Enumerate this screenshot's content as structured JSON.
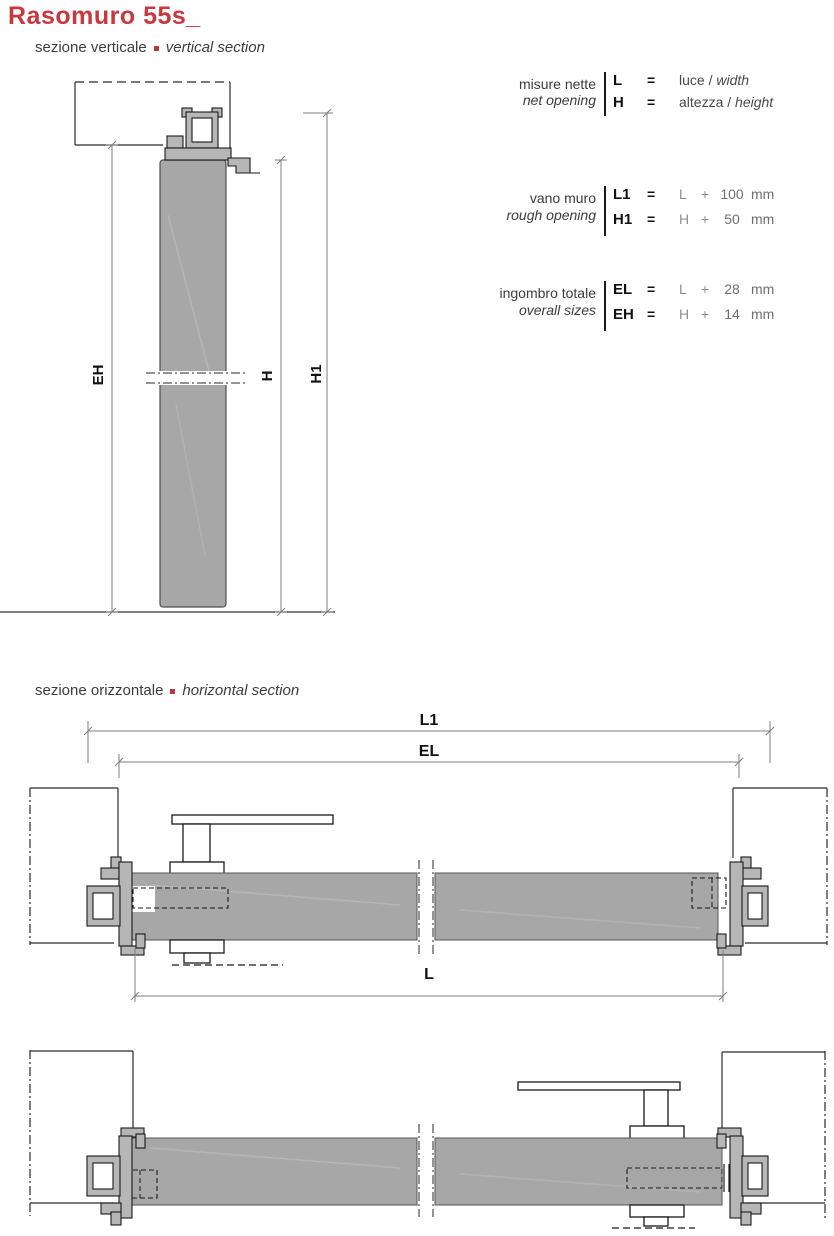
{
  "page": {
    "title": "Rasomuro 55s_"
  },
  "section_labels": {
    "vertical": {
      "it": "sezione verticale",
      "en": "vertical section"
    },
    "horizontal": {
      "it": "sezione orizzontale",
      "en": "horizontal section"
    }
  },
  "legend": {
    "blocks": [
      {
        "label_it": "misure nette",
        "label_en": "net opening",
        "rows": [
          {
            "sym": "L",
            "eq": "=",
            "text": "luce /",
            "text_italic": "width"
          },
          {
            "sym": "H",
            "eq": "=",
            "text": "altezza /",
            "text_italic": "height"
          }
        ]
      },
      {
        "label_it": "vano muro",
        "label_en": "rough opening",
        "rows": [
          {
            "sym": "L1",
            "eq": "=",
            "var": "L",
            "op": "+",
            "num": "100",
            "unit": "mm"
          },
          {
            "sym": "H1",
            "eq": "=",
            "var": "H",
            "op": "+",
            "num": "50",
            "unit": "mm"
          }
        ]
      },
      {
        "label_it": "ingombro totale",
        "label_en": "overall sizes",
        "rows": [
          {
            "sym": "EL",
            "eq": "=",
            "var": "L",
            "op": "+",
            "num": "28",
            "unit": "mm"
          },
          {
            "sym": "EH",
            "eq": "=",
            "var": "H",
            "op": "+",
            "num": "14",
            "unit": "mm"
          }
        ]
      }
    ]
  },
  "dim_labels": {
    "eh": "EH",
    "h": "H",
    "h1": "H1",
    "l1": "L1",
    "el": "EL",
    "l": "L"
  },
  "colors": {
    "accent": "#c8393f",
    "panel": "#a7a7a7",
    "dim_line": "#7d7d7d"
  }
}
